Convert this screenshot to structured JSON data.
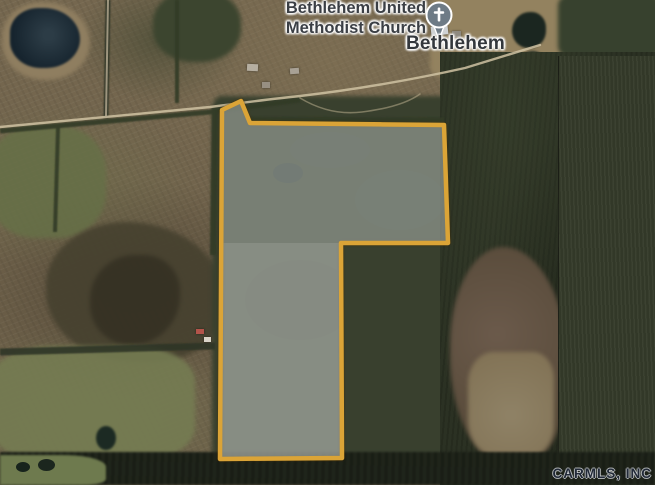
{
  "map": {
    "view_type": "satellite",
    "labels": {
      "church_name": "Bethlehem United\nMethodist Church",
      "place_name": "Bethlehem"
    },
    "poi_pin": {
      "icon": "church-cross-pin-icon",
      "color": "#6E7B86"
    },
    "parcel_boundary": {
      "points": "222,110 241,101 250,123 444,125 448,243 341,243 342,458 220,459",
      "stroke_color": "#DBA437",
      "fill_color": "#B2C6CE"
    },
    "watermark": "CARMLS, INC"
  }
}
